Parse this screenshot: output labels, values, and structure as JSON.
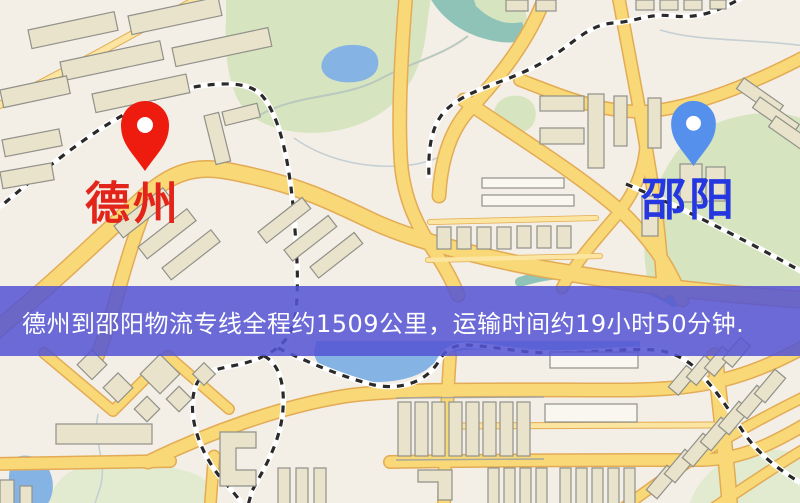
{
  "image_type": "logistics-route-map-banner",
  "banner": {
    "text": "德州到邵阳物流专线全程约1509公里，运输时间约19小时50分钟.",
    "background_color": "#5454d4",
    "text_color": "#ffffff"
  },
  "route": {
    "origin": "德州",
    "destination": "邵阳",
    "distance_km": "1509",
    "duration": "19小时50分钟"
  },
  "markers": {
    "origin": {
      "label": "德州",
      "label_color": "#e3241b",
      "pin_color": "#ee1c0e"
    },
    "destination": {
      "label": "邵阳",
      "label_color": "#2537e0",
      "pin_color": "#5590ec"
    }
  },
  "map_palette": {
    "background": "#f3efe6",
    "road_fill": "#f8d877",
    "road_casing": "#e3ab55",
    "building_fill": "#eae3cb",
    "building_outline": "#90918a",
    "green_area": "#d7e4c0",
    "water": "#85b4e4",
    "stream_teal": "#8fc3b8",
    "railway_dash": "#2a2a2a",
    "railway_casing": "#ffffff"
  }
}
